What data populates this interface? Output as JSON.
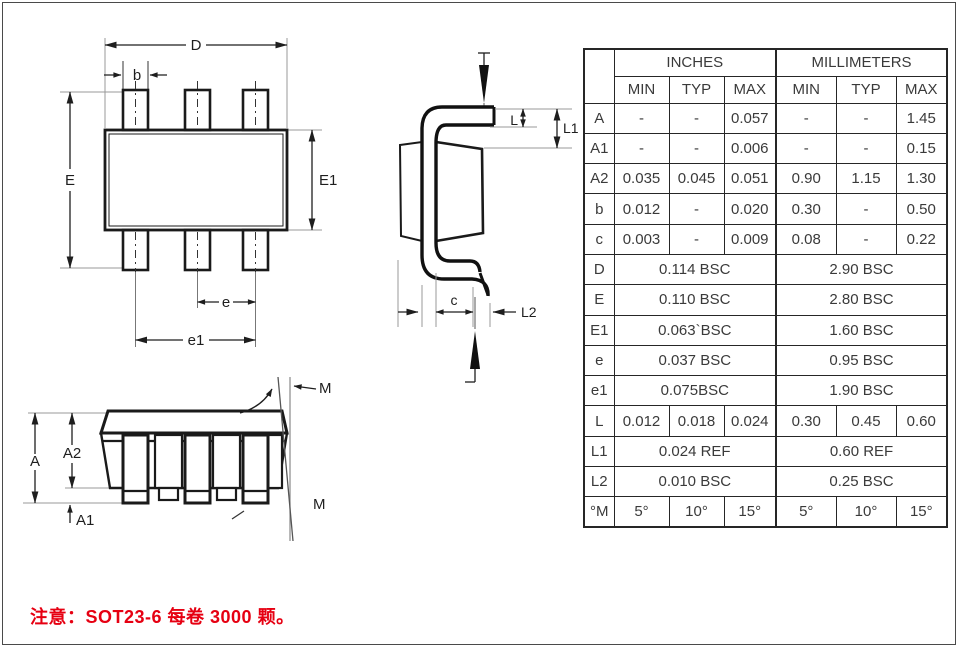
{
  "note": {
    "text": "注意：SOT23-6 每卷 3000 颗。"
  },
  "table": {
    "corner": "",
    "unit_headers": [
      "INCHES",
      "MILLIMETERS"
    ],
    "col_headers": [
      "MIN",
      "TYP",
      "MAX",
      "MIN",
      "TYP",
      "MAX"
    ],
    "rows": [
      {
        "sym": "A",
        "cells": [
          "-",
          "-",
          "0.057",
          "-",
          "-",
          "1.45"
        ]
      },
      {
        "sym": "A1",
        "cells": [
          "-",
          "-",
          "0.006",
          "-",
          "-",
          "0.15"
        ]
      },
      {
        "sym": "A2",
        "cells": [
          "0.035",
          "0.045",
          "0.051",
          "0.90",
          "1.15",
          "1.30"
        ]
      },
      {
        "sym": "b",
        "cells": [
          "0.012",
          "-",
          "0.020",
          "0.30",
          "-",
          "0.50"
        ]
      },
      {
        "sym": "c",
        "cells": [
          "0.003",
          "-",
          "0.009",
          "0.08",
          "-",
          "0.22"
        ]
      },
      {
        "sym": "D",
        "inches": "0.114 BSC",
        "mm": "2.90 BSC"
      },
      {
        "sym": "E",
        "inches": "0.110 BSC",
        "mm": "2.80 BSC"
      },
      {
        "sym": "E1",
        "inches": "0.063`BSC",
        "mm": "1.60 BSC"
      },
      {
        "sym": "e",
        "inches": "0.037 BSC",
        "mm": "0.95 BSC"
      },
      {
        "sym": "e1",
        "inches": "0.075BSC",
        "mm": "1.90 BSC"
      },
      {
        "sym": "L",
        "cells": [
          "0.012",
          "0.018",
          "0.024",
          "0.30",
          "0.45",
          "0.60"
        ]
      },
      {
        "sym": "L1",
        "inches": "0.024 REF",
        "mm": "0.60 REF"
      },
      {
        "sym": "L2",
        "inches": "0.010 BSC",
        "mm": "0.25 BSC"
      },
      {
        "sym": "°M",
        "cells": [
          "5°",
          "10°",
          "15°",
          "5°",
          "10°",
          "15°"
        ]
      }
    ]
  },
  "labels": {
    "top_view": {
      "D": "D",
      "b": "b",
      "E": "E",
      "E1": "E1",
      "e": "e",
      "e1": "e1"
    },
    "side_view": {
      "L": "L",
      "L1": "L1",
      "c": "c",
      "L2": "L2"
    },
    "front_view": {
      "A": "A",
      "A2": "A2",
      "A1": "A1",
      "M_top": "M",
      "M_bottom": "M"
    }
  },
  "colors": {
    "line": "#1a1a1a",
    "red_note": "#e60012"
  }
}
